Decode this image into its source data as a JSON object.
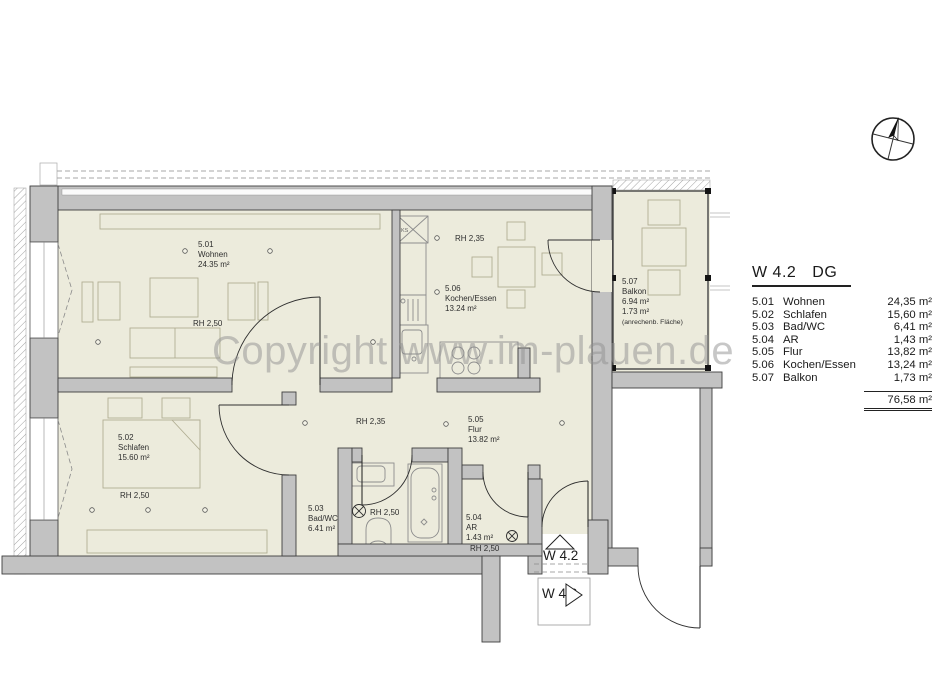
{
  "watermark": "Copyright www.im-plauen.de",
  "legend": {
    "title_unit": "W 4.2",
    "title_floor": "DG",
    "rows": [
      {
        "num": "5.01",
        "name": "Wohnen",
        "area": "24,35 m²"
      },
      {
        "num": "5.02",
        "name": "Schlafen",
        "area": "15,60 m²"
      },
      {
        "num": "5.03",
        "name": "Bad/WC",
        "area": "6,41 m²"
      },
      {
        "num": "5.04",
        "name": "AR",
        "area": "1,43 m²"
      },
      {
        "num": "5.05",
        "name": "Flur",
        "area": "13,82 m²"
      },
      {
        "num": "5.06",
        "name": "Kochen/Essen",
        "area": "13,24 m²"
      },
      {
        "num": "5.07",
        "name": "Balkon",
        "area": "1,73 m²"
      }
    ],
    "total": "76,58 m²"
  },
  "plan": {
    "rooms": {
      "wohnen": {
        "num": "5.01",
        "name": "Wohnen",
        "area": "24.35 m²",
        "rh": "RH 2,50"
      },
      "schlafen": {
        "num": "5.02",
        "name": "Schlafen",
        "area": "15.60 m²",
        "rh": "RH 2,50"
      },
      "bad": {
        "num": "5.03",
        "name": "Bad/WC",
        "area": "6.41 m²",
        "rh": "RH 2,50"
      },
      "ar": {
        "num": "5.04",
        "name": "AR",
        "area": "1.43 m²",
        "rh": "RH 2,50"
      },
      "flur": {
        "num": "5.05",
        "name": "Flur",
        "area": "13.82 m²",
        "rh": "RH 2,35"
      },
      "kochen": {
        "num": "5.06",
        "name": "Kochen/Essen",
        "area": "13.24 m²",
        "rh": "RH 2,35"
      },
      "balkon": {
        "num": "5.07",
        "name": "Balkon",
        "area": "6.94 m²",
        "area2": "1.73 m²",
        "note": "(anrechenb. Fläche)"
      }
    },
    "fixtures": {
      "fridge_label": "KS"
    },
    "markers": {
      "unit": "W 4.2",
      "neighbor": "W 4.3"
    }
  },
  "colors": {
    "wall": "#c2c2c2",
    "room_fill": "#ecebdc",
    "watermark": "#8f8f8f"
  }
}
